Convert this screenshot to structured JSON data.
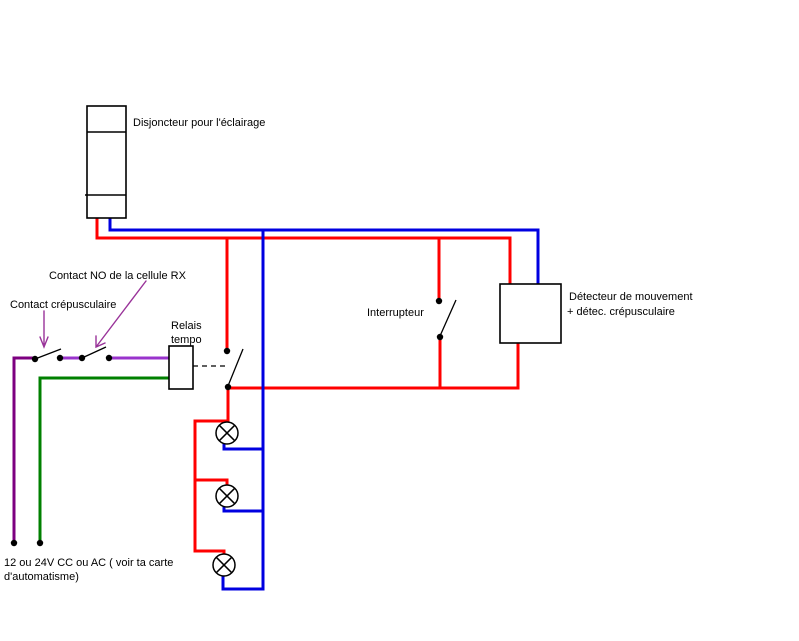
{
  "colors": {
    "background": "#FFFFFF",
    "black": "#000000",
    "wire_red": "#FF0000",
    "wire_blue": "#0000E0",
    "wire_green": "#008000",
    "wire_purple_dark": "#7D0080",
    "wire_purple_bright": "#9933CC",
    "arrow_purple": "#993399"
  },
  "components": {
    "breaker": {
      "label": "Disjoncteur pour l'éclairage"
    },
    "rx_cell_contact": {
      "label": "Contact NO de la cellule RX"
    },
    "twilight_contact": {
      "label": "Contact crépusculaire"
    },
    "timer_relay": {
      "label_line1": "Relais",
      "label_line2": "tempo"
    },
    "switch": {
      "label": "Interrupteur"
    },
    "motion_detector": {
      "label_line1": "Détecteur de mouvement",
      "label_line2": "+ détec. crépusculaire"
    },
    "low_voltage_supply": {
      "label_line1": "12 ou 24V CC ou AC ( voir ta carte",
      "label_line2": "d'automatisme)"
    },
    "lamps": {
      "count": 3
    }
  }
}
